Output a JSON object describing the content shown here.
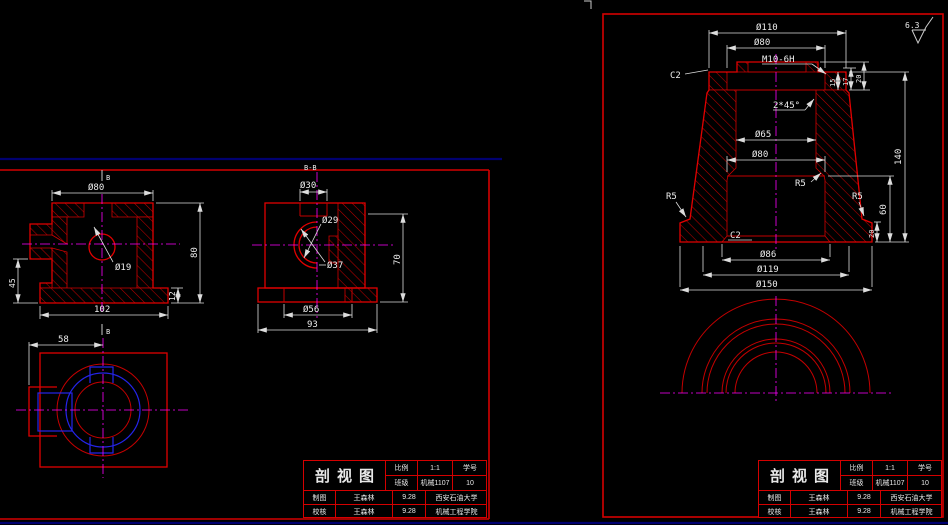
{
  "colors": {
    "background": "#000000",
    "outline_red": "#e00000",
    "hatch_red": "#c00000",
    "border_red": "#d40000",
    "frame_navy": "#000070",
    "dim_white": "#dcdcdc",
    "centerline_magenta": "#ff00ff",
    "hidden_blue": "#2424e8"
  },
  "left_sheet": {
    "section_marker": "B",
    "view_a": {
      "dia_top": "Ø80",
      "dia_hole": "Ø19",
      "height": "80",
      "foot_height": "12",
      "side_height": "45",
      "width": "102"
    },
    "view_b": {
      "section_label": "B-B",
      "dia_top": "Ø30",
      "dia_arc_small": "Ø29",
      "dia_arc_large": "Ø37",
      "height": "70",
      "dia_base": "Ø56",
      "width": "93"
    },
    "view_c": {
      "offset": "58"
    }
  },
  "right_sheet": {
    "roughness": "6.3",
    "view_main": {
      "dia_flange": "Ø110",
      "dia_recess": "Ø80",
      "thread": "M10-6H",
      "chamfer_top": "C2",
      "chamfer_bore": "2*45°",
      "depth_15": "15",
      "depth_17": "17",
      "depth_20": "20",
      "dia_bore": "Ø65",
      "dia_lower_bore": "Ø80",
      "fillet_inner": "R5",
      "fillet_left": "R5",
      "fillet_right": "R5",
      "height_total": "140",
      "height_lower": "60",
      "height_base": "20",
      "chamfer_bottom": "C2",
      "dia_opening": "Ø86",
      "dia_mid": "Ø119",
      "dia_base": "Ø150"
    }
  },
  "title_block": {
    "title": "剖视图",
    "scale_label": "比例",
    "scale_value": "1:1",
    "class_label": "班级",
    "class_value": "机械1107",
    "sid_label": "学号",
    "sid_value": "10",
    "drawn_label": "制图",
    "drawn_name": "王森林",
    "drawn_date": "9.28",
    "checked_label": "校核",
    "checked_name": "王森林",
    "checked_date": "9.28",
    "school": "西安石油大学",
    "college": "机械工程学院"
  }
}
